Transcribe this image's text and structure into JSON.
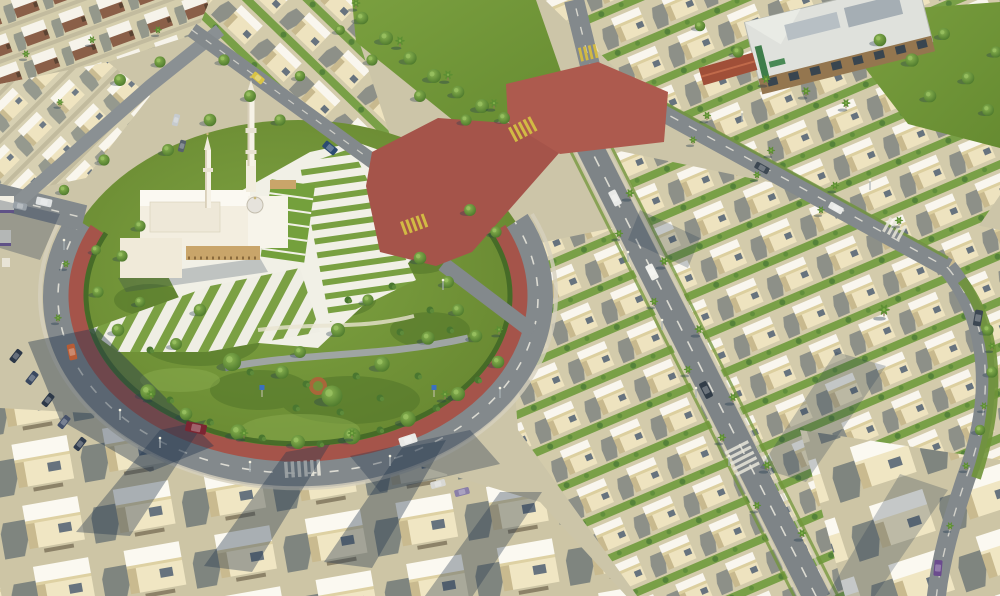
{
  "meta": {
    "media_type": "3d-aerial-architectural-render",
    "description": "Aerial view of a suburban residential compound: rows of cream villas, a white mosque with two minarets beside a triangular plaza, a landscaped central park encircled by a ring road with a red-brick inner band, a large red-brick intersection, a community building with gray roof at top right, palm-lined streets, scattered cars and long afternoon shadows.",
    "visible_text": "none"
  },
  "palette": {
    "ground": "#ccc5a8",
    "villa_wall": "#efe4c0",
    "villa_roof": "#f9f6ed",
    "asphalt": "#83898c",
    "asphalt_dark": "#7e8487",
    "brick_red": "#a5544a",
    "brick_light": "#ad5a4e",
    "grass": "#7fa442",
    "grass_dark": "#52752a",
    "tree_green": "#436f26",
    "palm_green": "#5d8f33",
    "plaza_white": "#f1f0e6",
    "shadow_blue": "#24364e",
    "crosswalk_yellow": "#d2ba44",
    "curb": "#d6d0bd",
    "building_roof": "#dfe1dc",
    "building_wood": "#94764f",
    "sign_green": "#3e7d4a",
    "gate_roof": "#a04f38",
    "sign_blue": "#3a70c0"
  },
  "scene": {
    "landmarks": [
      {
        "name": "mosque",
        "features": [
          "two minarets",
          "dome",
          "white prayer hall",
          "tan colonnade",
          "forecourt plaza"
        ]
      },
      {
        "name": "central-park",
        "features": [
          "ring road",
          "red-brick band",
          "striped lawns",
          "walking path",
          "round planter",
          "park signboards"
        ]
      },
      {
        "name": "brick-intersection-plaza"
      },
      {
        "name": "community-building",
        "features": [
          "gray hipped roof",
          "wood facade",
          "green signage",
          "clay-roof gate"
        ]
      },
      {
        "name": "villa-districts"
      }
    ],
    "counts": {
      "minarets": 2
    },
    "vehicles": [
      {
        "x": 196,
        "y": 428,
        "rot": 12,
        "len": 21,
        "wid": 10,
        "color": "#7b2531"
      },
      {
        "x": 72,
        "y": 352,
        "rot": 78,
        "len": 16,
        "wid": 8,
        "color": "#b85c35"
      },
      {
        "x": 408,
        "y": 440,
        "rot": -18,
        "len": 18,
        "wid": 9,
        "color": "#e9e9e6"
      },
      {
        "x": 44,
        "y": 202,
        "rot": 12,
        "len": 16,
        "wid": 8,
        "color": "#dfe2e2"
      },
      {
        "x": 20,
        "y": 206,
        "rot": 12,
        "len": 14,
        "wid": 7,
        "color": "#9aa2a8"
      },
      {
        "x": 330,
        "y": 148,
        "rot": 40,
        "len": 15,
        "wid": 8,
        "color": "#2c4b72"
      },
      {
        "x": 258,
        "y": 78,
        "rot": 40,
        "len": 13,
        "wid": 7,
        "color": "#d9c445"
      },
      {
        "x": 615,
        "y": 198,
        "rot": 63,
        "len": 16,
        "wid": 8,
        "color": "#e8e9e7"
      },
      {
        "x": 652,
        "y": 272,
        "rot": 63,
        "len": 16,
        "wid": 8,
        "color": "#f0f0ec"
      },
      {
        "x": 706,
        "y": 390,
        "rot": 63,
        "len": 17,
        "wid": 8,
        "color": "#323d48"
      },
      {
        "x": 836,
        "y": 208,
        "rot": 29,
        "len": 15,
        "wid": 7,
        "color": "#e8e9e7"
      },
      {
        "x": 762,
        "y": 168,
        "rot": 29,
        "len": 15,
        "wid": 7,
        "color": "#3c4752"
      },
      {
        "x": 978,
        "y": 318,
        "rot": 100,
        "len": 16,
        "wid": 8,
        "color": "#3c4752"
      },
      {
        "x": 938,
        "y": 568,
        "rot": 95,
        "len": 16,
        "wid": 8,
        "color": "#6b4b8e"
      },
      {
        "x": 176,
        "y": 120,
        "rot": -75,
        "len": 12,
        "wid": 6,
        "color": "#c6cbcf"
      },
      {
        "x": 182,
        "y": 146,
        "rot": -75,
        "len": 12,
        "wid": 6,
        "color": "#57616b"
      },
      {
        "x": 16,
        "y": 356,
        "rot": -52,
        "len": 14,
        "wid": 7,
        "color": "#2c3848"
      },
      {
        "x": 32,
        "y": 378,
        "rot": -52,
        "len": 14,
        "wid": 7,
        "color": "#3a4860"
      },
      {
        "x": 48,
        "y": 400,
        "rot": -52,
        "len": 14,
        "wid": 7,
        "color": "#2c3848"
      },
      {
        "x": 64,
        "y": 422,
        "rot": -52,
        "len": 14,
        "wid": 7,
        "color": "#46526a"
      },
      {
        "x": 80,
        "y": 444,
        "rot": -52,
        "len": 14,
        "wid": 7,
        "color": "#303c4e"
      },
      {
        "x": 462,
        "y": 492,
        "rot": -15,
        "len": 15,
        "wid": 7,
        "color": "#8a7fa8"
      },
      {
        "x": 438,
        "y": 484,
        "rot": -15,
        "len": 15,
        "wid": 7,
        "color": "#d8d8d4"
      }
    ],
    "vegetation": {
      "trees": [
        [
          148,
          392,
          1.1
        ],
        [
          186,
          414,
          0.9
        ],
        [
          238,
          432,
          1.1
        ],
        [
          298,
          442,
          1.0
        ],
        [
          352,
          436,
          1.2
        ],
        [
          408,
          419,
          1.1
        ],
        [
          458,
          394,
          1.0
        ],
        [
          498,
          362,
          0.9
        ],
        [
          232,
          362,
          1.3
        ],
        [
          282,
          372,
          0.95
        ],
        [
          332,
          396,
          1.5
        ],
        [
          382,
          364,
          1.1
        ],
        [
          428,
          338,
          0.95
        ],
        [
          458,
          310,
          0.85
        ],
        [
          118,
          330,
          0.9
        ],
        [
          98,
          292,
          0.8
        ],
        [
          140,
          302,
          0.75
        ],
        [
          122,
          256,
          0.8
        ],
        [
          338,
          330,
          1.0
        ],
        [
          300,
          352,
          0.85
        ],
        [
          368,
          300,
          0.8
        ],
        [
          420,
          258,
          0.9
        ],
        [
          448,
          282,
          0.85
        ],
        [
          200,
          310,
          0.9
        ],
        [
          176,
          344,
          0.85
        ],
        [
          476,
          336,
          0.9
        ],
        [
          140,
          226,
          0.8
        ],
        [
          96,
          250,
          0.7
        ],
        [
          362,
          18,
          0.9
        ],
        [
          386,
          38,
          1.0
        ],
        [
          410,
          58,
          0.95
        ],
        [
          434,
          76,
          1.0
        ],
        [
          458,
          92,
          0.9
        ],
        [
          482,
          106,
          1.0
        ],
        [
          504,
          118,
          0.85
        ],
        [
          372,
          60,
          0.8
        ],
        [
          420,
          96,
          0.85
        ],
        [
          466,
          120,
          0.8
        ],
        [
          340,
          30,
          0.7
        ],
        [
          880,
          40,
          0.9
        ],
        [
          912,
          60,
          0.95
        ],
        [
          944,
          34,
          0.85
        ],
        [
          968,
          78,
          0.9
        ],
        [
          988,
          110,
          0.85
        ],
        [
          930,
          96,
          0.9
        ],
        [
          738,
          52,
          0.8
        ],
        [
          700,
          26,
          0.75
        ],
        [
          996,
          52,
          0.8
        ],
        [
          160,
          62,
          0.8
        ],
        [
          120,
          80,
          0.85
        ],
        [
          224,
          60,
          0.8
        ],
        [
          250,
          96,
          0.85
        ],
        [
          210,
          120,
          0.9
        ],
        [
          168,
          150,
          0.85
        ],
        [
          104,
          160,
          0.8
        ],
        [
          64,
          190,
          0.75
        ],
        [
          280,
          120,
          0.8
        ],
        [
          300,
          76,
          0.75
        ],
        [
          470,
          210,
          0.85
        ],
        [
          496,
          232,
          0.8
        ],
        [
          988,
          330,
          0.8
        ],
        [
          992,
          372,
          0.8
        ],
        [
          980,
          430,
          0.75
        ]
      ],
      "bushes": [
        [
          170,
          400
        ],
        [
          210,
          422
        ],
        [
          262,
          438
        ],
        [
          320,
          444
        ],
        [
          380,
          430
        ],
        [
          436,
          408
        ],
        [
          478,
          380
        ],
        [
          250,
          372
        ],
        [
          306,
          384
        ],
        [
          356,
          376
        ],
        [
          150,
          350
        ],
        [
          450,
          330
        ],
        [
          400,
          332
        ],
        [
          430,
          310
        ],
        [
          340,
          412
        ],
        [
          296,
          408
        ],
        [
          380,
          398
        ],
        [
          418,
          376
        ],
        [
          348,
          300
        ],
        [
          392,
          286
        ]
      ],
      "palms": [
        [
          151,
          399,
          0.7
        ],
        [
          244,
          438,
          0.7
        ],
        [
          352,
          438,
          0.7
        ],
        [
          445,
          399,
          0.7
        ],
        [
          499,
          334,
          0.65
        ],
        [
          66,
          268,
          0.6
        ],
        [
          58,
          322,
          0.6
        ],
        [
          707,
          120,
          0.65
        ],
        [
          771,
          155,
          0.65
        ],
        [
          835,
          190,
          0.65
        ],
        [
          899,
          225,
          0.65
        ],
        [
          693,
          144,
          0.6
        ],
        [
          757,
          179,
          0.6
        ],
        [
          821,
          214,
          0.6
        ],
        [
          630,
          198,
          0.7
        ],
        [
          664,
          266,
          0.7
        ],
        [
          699,
          334,
          0.7
        ],
        [
          733,
          402,
          0.7
        ],
        [
          767,
          470,
          0.7
        ],
        [
          802,
          538,
          0.7
        ],
        [
          619,
          238,
          0.65
        ],
        [
          654,
          306,
          0.65
        ],
        [
          688,
          374,
          0.65
        ],
        [
          722,
          442,
          0.65
        ],
        [
          757,
          510,
          0.65
        ],
        [
          992,
          350,
          0.6
        ],
        [
          984,
          410,
          0.6
        ],
        [
          966,
          470,
          0.6
        ],
        [
          950,
          530,
          0.6
        ],
        [
          26,
          58,
          0.6
        ],
        [
          92,
          44,
          0.6
        ],
        [
          158,
          34,
          0.6
        ],
        [
          60,
          106,
          0.55
        ],
        [
          356,
          8,
          0.7
        ],
        [
          400,
          46,
          0.75
        ],
        [
          448,
          80,
          0.75
        ],
        [
          494,
          108,
          0.7
        ],
        [
          766,
          84,
          0.7
        ],
        [
          806,
          96,
          0.7
        ],
        [
          846,
          108,
          0.7
        ],
        [
          884,
          316,
          0.9
        ]
      ],
      "lights": [
        [
          628,
          262
        ],
        [
          662,
          330
        ],
        [
          696,
          398
        ],
        [
          729,
          466
        ],
        [
          120,
          420
        ],
        [
          250,
          472
        ],
        [
          390,
          466
        ],
        [
          500,
          398
        ],
        [
          742,
          122
        ],
        [
          870,
          190
        ],
        [
          64,
          250
        ],
        [
          160,
          448
        ],
        [
          443,
          290
        ]
      ]
    },
    "park_signs": [
      [
        262,
        390
      ],
      [
        434,
        390
      ]
    ]
  }
}
